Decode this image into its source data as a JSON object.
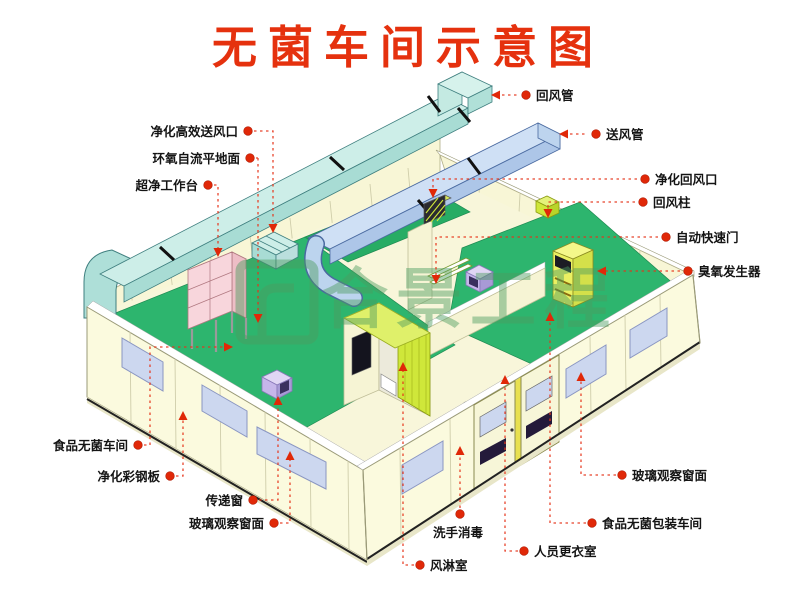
{
  "title": {
    "text": "无菌车间示意图",
    "color": "#e5310e"
  },
  "watermark": {
    "text": "合景工程",
    "logo": "gate-logo",
    "color": "#4c9c60"
  },
  "colors": {
    "title_red": "#e5310e",
    "leader_red": "#e6341a",
    "wall_cream": "#fbfade",
    "floor_cream": "#f8f6da",
    "floor_green": "#2db56e",
    "duct_cyan": "#cdeee8",
    "duct_blue": "#cfe0f5",
    "lime_green": "#cfe73a",
    "window_blue": "#ccd7ef",
    "bench_pink": "#f8d6dc",
    "cabinet_yellow": "#eaf062",
    "transfer_purple": "#c6b6ea",
    "watermark_green": "#4c9c60"
  },
  "annotations": {
    "supply_outlet": {
      "label": "净化高效送风口"
    },
    "epoxy_floor": {
      "label": "环氧自流平地面"
    },
    "clean_bench": {
      "label": "超净工作台"
    },
    "food_room": {
      "label": "食品无菌车间"
    },
    "steel_panel": {
      "label": "净化彩钢板"
    },
    "transfer_window": {
      "label": "传递窗"
    },
    "glass_window_l": {
      "label": "玻璃观察窗面"
    },
    "air_shower": {
      "label": "风淋室"
    },
    "hand_wash": {
      "label": "洗手消毒"
    },
    "changing_room": {
      "label": "人员更衣室"
    },
    "packaging_room": {
      "label": "食品无菌包装车间"
    },
    "glass_window_r": {
      "label": "玻璃观察窗面"
    },
    "return_duct": {
      "label": "回风管"
    },
    "supply_duct": {
      "label": "送风管"
    },
    "return_grille": {
      "label": "净化回风口"
    },
    "return_column": {
      "label": "回风柱"
    },
    "auto_door": {
      "label": "自动快速门"
    },
    "ozone_generator": {
      "label": "臭氧发生器"
    }
  }
}
